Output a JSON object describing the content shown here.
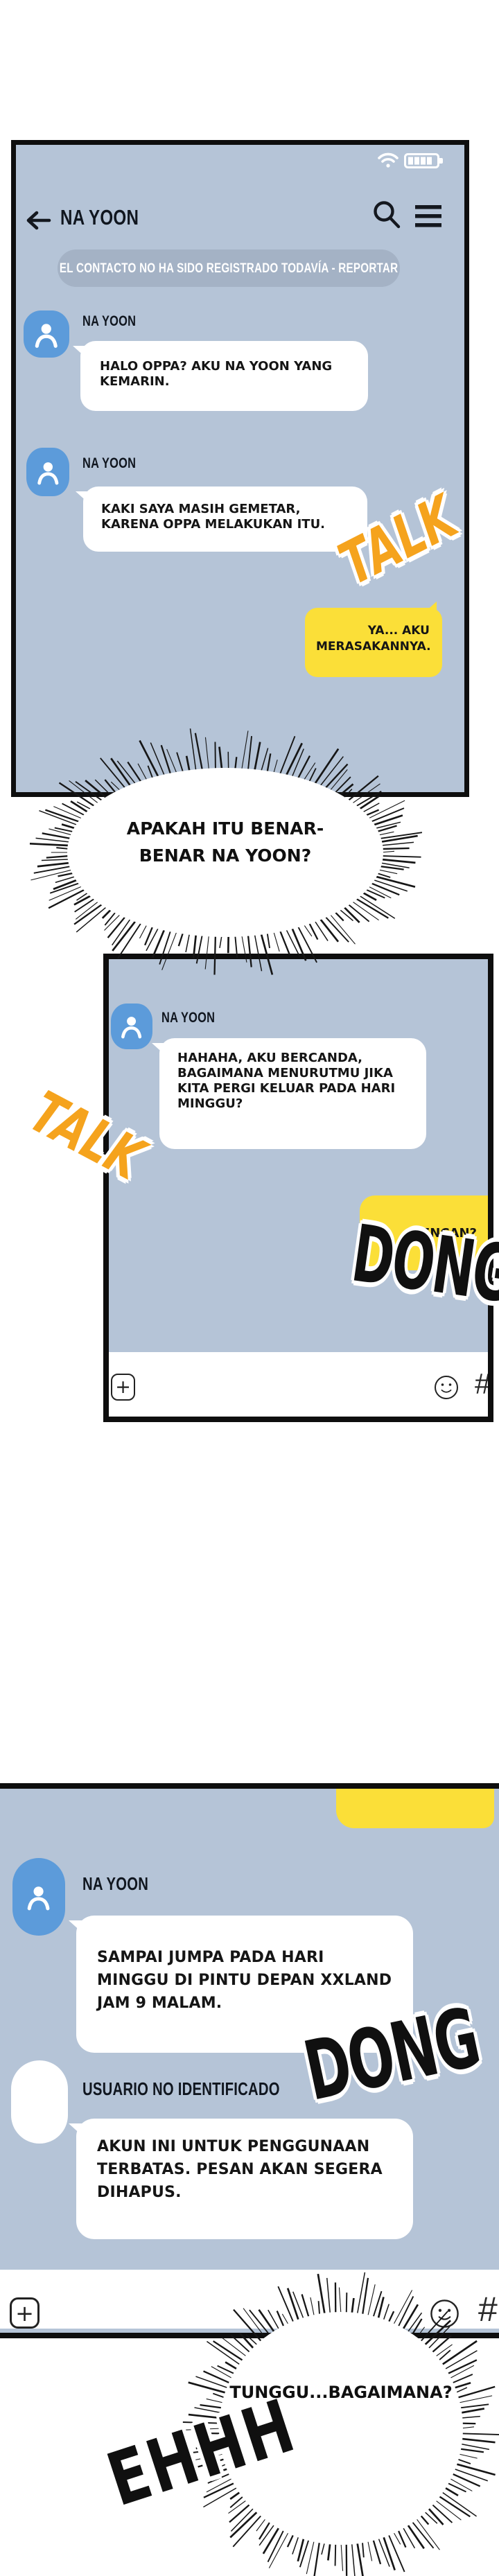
{
  "colors": {
    "panel_bg": "#b5c4d7",
    "ink": "#0e0e0e",
    "yellow": "#fbdf38",
    "orange": "#f5a31d",
    "avatar_blue": "#5c9bda",
    "banner_bg": "#a4b2c5"
  },
  "panel1": {
    "status": {
      "wifi_icon": "wifi",
      "battery_icon": "battery-full"
    },
    "header": {
      "back_icon": "arrow-left",
      "title": "NA YOON",
      "search_icon": "magnifier",
      "menu_icon": "hamburger"
    },
    "banner": {
      "label": "EL CONTACTO NO HA SIDO REGISTRADO TODAVÍA - REPORTAR"
    },
    "messages": [
      {
        "sender": "NA YOON",
        "text": "HALO OPPA? AKU NA YOON YANG KEMARIN."
      },
      {
        "sender": "NA YOON",
        "text": "KAKI SAYA MASIH GEMETAR, KARENA OPPA MELAKUKAN ITU."
      }
    ],
    "outgoing": {
      "text": "YA... AKU MERASAKANNYA."
    },
    "sfx": {
      "talk": "TALK"
    }
  },
  "burst1": {
    "line1": "APAKAH ITU BENAR-",
    "line2": "BENAR NA YOON?"
  },
  "panel2": {
    "messages": [
      {
        "sender": "NA YOON",
        "text": "HAHAHA, AKU BERCANDA, BAGAIMANA MENURUTMU JIKA KITA PERGI KELUAR PADA HARI MINGGU?"
      }
    ],
    "outgoing": {
      "text": "KENCAN?"
    },
    "sfx": {
      "talk": "TALK",
      "dong": "DONG"
    },
    "input_bar": {
      "plus": "+",
      "hash": "#"
    }
  },
  "panel3": {
    "messages": [
      {
        "sender": "NA YOON",
        "text": "SAMPAI JUMPA PADA HARI MINGGU DI PINTU DEPAN XXLAND JAM 9 MALAM."
      },
      {
        "sender": "USUARIO NO IDENTIFICADO",
        "text": "AKUN INI UNTUK PENGGUNAAN TERBATAS. PESAN AKAN SEGERA DIHAPUS."
      }
    ],
    "sfx": {
      "dong": "DONG",
      "ehhh": "EHHH"
    },
    "input_bar": {
      "plus": "+",
      "hash": "#"
    }
  },
  "burst2": {
    "line1": "TUNGGU...BAGAIMANA?"
  }
}
